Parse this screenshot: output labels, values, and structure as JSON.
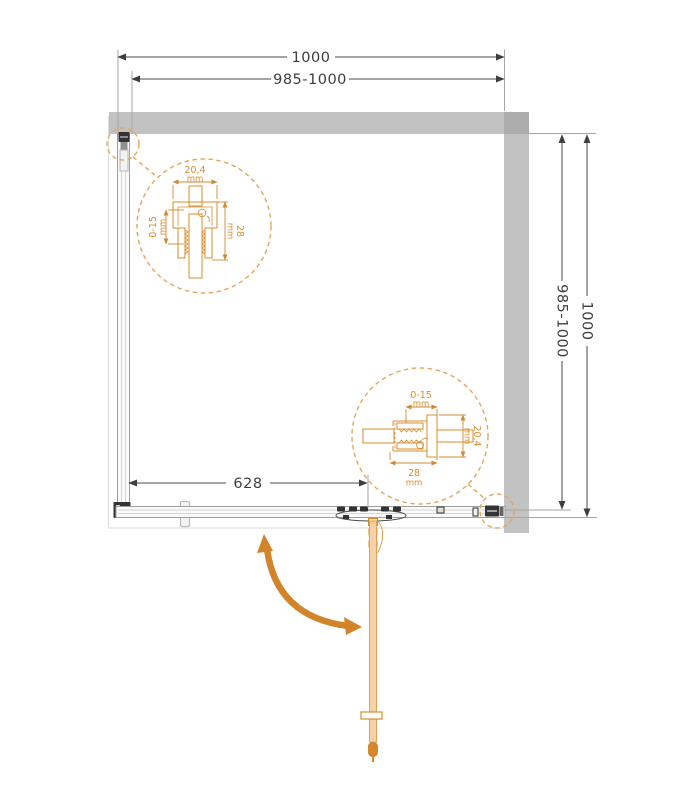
{
  "drawing": {
    "dimensions": {
      "top_outer": "1000",
      "top_inner": "985-1000",
      "right_outer": "1000",
      "right_inner": "985-1000",
      "bottom_door": "628"
    },
    "detail_callout_top_left": {
      "profile_width": "20,4",
      "profile_width_unit": "mm",
      "adjustment_range": "0-15",
      "adjustment_unit": "mm",
      "profile_depth": "28",
      "profile_depth_unit": "mm"
    },
    "detail_callout_bottom_right": {
      "adjustment_range": "0-15",
      "adjustment_unit": "mm",
      "profile_depth": "28",
      "profile_depth_unit": "mm",
      "profile_width": "20,4",
      "profile_width_unit": "mm"
    },
    "colors": {
      "wall_gray": "#C2C2C2",
      "wall_overlap_gray": "#ADADAD",
      "accent_orange": "#D98C2B",
      "callout_dash_orange": "#E2A75B",
      "door_fill": "#F4D2A6",
      "door_edge": "#E0A258",
      "arrow_orange": "#D1842A",
      "dimension_text": "#3E3E3E"
    }
  }
}
